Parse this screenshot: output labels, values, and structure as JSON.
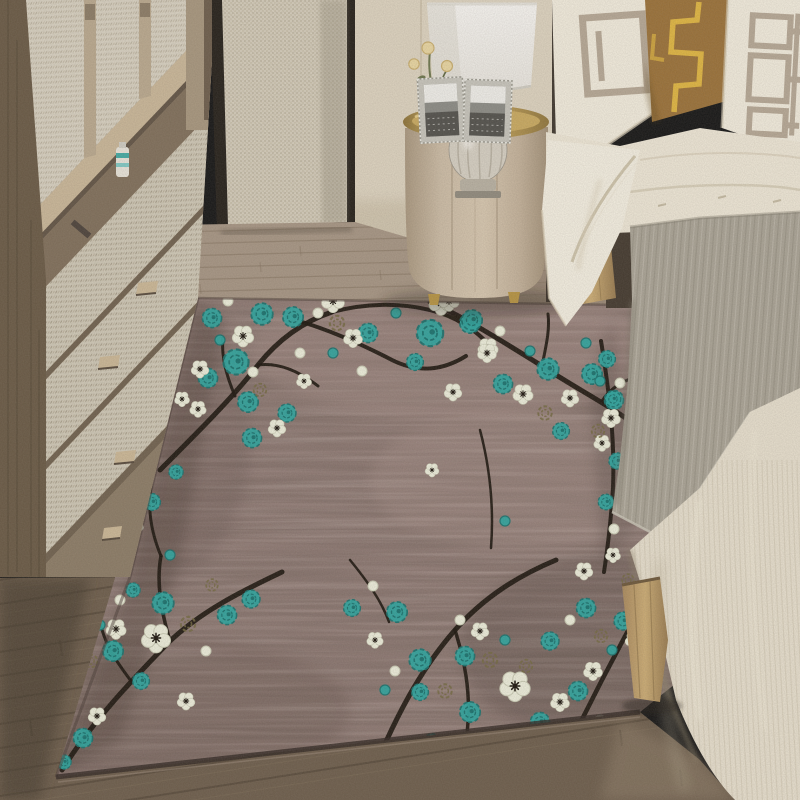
{
  "scene": {
    "title": "Bedroom interior photo with plum-blossom area rug",
    "description": "Photograph: beige wardrobe with woven-fabric doors on the left, black-framed fabric screen, round champagne nightstand with crystal lamp and two photo frames, bed with white and bronze geometric pillows on the right, and a large mauve-brown rug with teal and white plum blossoms on black branches covering a wood floor.",
    "objects": [
      "wardrobe",
      "fabric-screen",
      "wall",
      "wood-floor",
      "area-rug",
      "nightstand",
      "table-lamp",
      "photo-frames",
      "gold-flowers",
      "bed",
      "pillows",
      "duvet",
      "gray-throw",
      "bedspread",
      "bed-legs"
    ]
  },
  "palette": {
    "wall": "#ddd3bf",
    "wall_trim": "#3b332a",
    "wardrobe_wood": "#b3a086",
    "wardrobe_side": "#675742",
    "screen_frame": "#211c16",
    "floor_light": "#a59482",
    "floor_mid": "#6b5b49",
    "plank_line": "#7c6a57",
    "nightstand_body": "#c9b9a2",
    "tray_gold": "#c5a55c",
    "handle_gold": "#c8a348",
    "lamp_shade": "#f5f3ee",
    "crystal": "#d5cfc2",
    "frame_silver": "#c6c4bb",
    "flower_gold": "#e9d6a0",
    "stem_green": "#6a734a",
    "pillow_white": "#f2ecdd",
    "pillow_taupe": "#b5a794",
    "pillow_brown": "#996f35",
    "pillow_gold_line": "#e0b53e",
    "duvet": "#eee7d6",
    "sheet": "#f4efe1",
    "throw_gray": "#a8a294",
    "throw_rib": "#8e887a",
    "throw_rib_light": "#c2bdb0",
    "bedspread": "#e7dfcd",
    "bedspread_shadow": "#c9c0ab",
    "bed_leg": "#c2a268",
    "rug_base": "#8d7872",
    "rug_edge": "#2e241f",
    "branch": "#171009",
    "teal": "#2aa49e",
    "teal_dark": "#15706c",
    "blossom_white": "#edeedb",
    "blossom_edge": "#c8c9b2",
    "olive": "#71663e"
  },
  "rug": {
    "branches": [
      [
        "M160,470 C200,430 235,395 258,365 C278,340 302,322 332,312",
        5
      ],
      [
        "M258,365 C280,362 300,372 318,386",
        3
      ],
      [
        "M235,396 C226,375 221,356 223,338",
        3
      ],
      [
        "M302,322 C335,332 365,346 392,360 C418,373 442,371 466,356",
        4
      ],
      [
        "M332,312 C362,304 396,302 430,310 C456,316 477,331 490,346",
        4
      ],
      [
        "M430,302 C462,316 502,341 542,366 C572,386 602,401 630,421 C646,432 656,452 659,472",
        5
      ],
      [
        "M542,366 C546,346 550,330 548,314",
        3
      ],
      [
        "M602,401 C612,386 626,379 641,376",
        3
      ],
      [
        "M601,341 C609,390 615,438 613,488 C611,520 608,546 604,572",
        4
      ],
      [
        "M62,770 C92,722 130,682 170,641 C202,611 240,592 282,572",
        5
      ],
      [
        "M170,641 C161,611 156,582 161,556",
        3.5
      ],
      [
        "M131,681 C116,661 106,646 101,626",
        3
      ],
      [
        "M161,556 C150,530 147,505 152,480",
        3
      ],
      [
        "M372,774 C395,718 420,670 455,630 C485,596 520,575 556,560",
        5
      ],
      [
        "M455,630 C465,662 470,690 468,722 C467,740 464,758 460,775",
        3.5
      ],
      [
        "M561,762 C589,704 612,660 636,616 C646,596 652,576 655,556",
        4.5
      ],
      [
        "M636,616 C644,640 646,664 642,690",
        3
      ],
      [
        "M480,430 C490,468 494,508 491,548",
        2.5
      ],
      [
        "M350,560 C368,582 382,602 389,622",
        2.5
      ]
    ],
    "flowers": {
      "teal": [
        [
          212,
          318,
          0.8
        ],
        [
          262,
          314,
          0.9
        ],
        [
          236,
          362,
          1.05
        ],
        [
          208,
          378,
          0.8
        ],
        [
          248,
          402,
          0.85
        ],
        [
          252,
          438,
          0.8
        ],
        [
          287,
          413,
          0.75
        ],
        [
          293,
          317,
          0.85
        ],
        [
          368,
          333,
          0.8
        ],
        [
          430,
          333,
          1.1
        ],
        [
          470,
          323,
          0.85
        ],
        [
          415,
          362,
          0.7
        ],
        [
          472,
          320,
          0.85
        ],
        [
          548,
          369,
          0.9
        ],
        [
          503,
          384,
          0.8
        ],
        [
          592,
          374,
          0.85
        ],
        [
          614,
          400,
          0.8
        ],
        [
          561,
          431,
          0.7
        ],
        [
          607,
          359,
          0.7
        ],
        [
          613,
          399,
          0.65
        ],
        [
          617,
          461,
          0.68
        ],
        [
          606,
          502,
          0.65
        ],
        [
          163,
          603,
          0.9
        ],
        [
          227,
          615,
          0.8
        ],
        [
          113,
          651,
          0.85
        ],
        [
          83,
          738,
          0.8
        ],
        [
          64,
          762,
          0.6
        ],
        [
          141,
          681,
          0.7
        ],
        [
          251,
          599,
          0.75
        ],
        [
          133,
          590,
          0.6
        ],
        [
          152,
          502,
          0.7
        ],
        [
          176,
          472,
          0.6
        ],
        [
          420,
          660,
          0.9
        ],
        [
          465,
          656,
          0.8
        ],
        [
          550,
          641,
          0.75
        ],
        [
          420,
          692,
          0.7
        ],
        [
          470,
          712,
          0.85
        ],
        [
          540,
          722,
          0.8
        ],
        [
          500,
          757,
          0.8
        ],
        [
          432,
          742,
          0.7
        ],
        [
          397,
          612,
          0.85
        ],
        [
          352,
          608,
          0.7
        ],
        [
          586,
          608,
          0.8
        ],
        [
          623,
          621,
          0.75
        ],
        [
          578,
          691,
          0.8
        ],
        [
          569,
          746,
          0.7
        ],
        [
          648,
          560,
          0.7
        ],
        [
          640,
          598,
          0.7
        ]
      ],
      "white": [
        [
          243,
          336,
          0.85
        ],
        [
          200,
          369,
          0.7
        ],
        [
          182,
          399,
          0.6
        ],
        [
          198,
          409,
          0.65
        ],
        [
          277,
          428,
          0.7
        ],
        [
          304,
          381,
          0.6
        ],
        [
          353,
          338,
          0.75
        ],
        [
          333,
          301,
          0.9
        ],
        [
          441,
          303,
          0.95
        ],
        [
          488,
          348,
          0.8
        ],
        [
          449,
          301,
          0.8
        ],
        [
          487,
          353,
          0.75
        ],
        [
          453,
          392,
          0.7
        ],
        [
          523,
          394,
          0.8
        ],
        [
          570,
          398,
          0.7
        ],
        [
          611,
          418,
          0.75
        ],
        [
          602,
          443,
          0.65
        ],
        [
          613,
          555,
          0.6
        ],
        [
          156,
          638,
          1.15
        ],
        [
          116,
          629,
          0.8
        ],
        [
          31,
          706,
          0.8
        ],
        [
          97,
          716,
          0.7
        ],
        [
          186,
          701,
          0.7
        ],
        [
          136,
          526,
          0.6
        ],
        [
          515,
          686,
          1.2
        ],
        [
          480,
          631,
          0.7
        ],
        [
          560,
          702,
          0.75
        ],
        [
          420,
          770,
          0.75
        ],
        [
          375,
          640,
          0.65
        ],
        [
          584,
          571,
          0.7
        ],
        [
          593,
          671,
          0.75
        ],
        [
          561,
          758,
          0.7
        ],
        [
          634,
          640,
          0.7
        ],
        [
          432,
          470,
          0.55
        ]
      ],
      "olive": [
        [
          337,
          323,
          0.8
        ],
        [
          260,
          390,
          0.7
        ],
        [
          545,
          413,
          0.75
        ],
        [
          598,
          431,
          0.7
        ],
        [
          188,
          624,
          0.8
        ],
        [
          91,
          661,
          0.7
        ],
        [
          212,
          585,
          0.65
        ],
        [
          445,
          691,
          0.75
        ],
        [
          526,
          666,
          0.7
        ],
        [
          490,
          660,
          0.8
        ],
        [
          601,
          636,
          0.7
        ],
        [
          628,
          580,
          0.65
        ]
      ],
      "tbud": [
        [
          333,
          353,
          1
        ],
        [
          396,
          313,
          1
        ],
        [
          220,
          340,
          1
        ],
        [
          530,
          351,
          1
        ],
        [
          586,
          343,
          1
        ],
        [
          600,
          381,
          1
        ],
        [
          100,
          625,
          1
        ],
        [
          170,
          555,
          1
        ],
        [
          505,
          640,
          1
        ],
        [
          385,
          690,
          1
        ],
        [
          612,
          650,
          1
        ],
        [
          505,
          521,
          1
        ]
      ],
      "wbud": [
        [
          228,
          301,
          1
        ],
        [
          318,
          313,
          1
        ],
        [
          362,
          371,
          1
        ],
        [
          300,
          353,
          1
        ],
        [
          253,
          372,
          1
        ],
        [
          500,
          331,
          1
        ],
        [
          620,
          383,
          1
        ],
        [
          614,
          529,
          1
        ],
        [
          206,
          651,
          1
        ],
        [
          60,
          700,
          1
        ],
        [
          120,
          600,
          1
        ],
        [
          395,
          671,
          1
        ],
        [
          545,
          760,
          1
        ],
        [
          460,
          620,
          1
        ],
        [
          570,
          620,
          1
        ],
        [
          600,
          720,
          1
        ],
        [
          373,
          586,
          1
        ]
      ]
    }
  }
}
